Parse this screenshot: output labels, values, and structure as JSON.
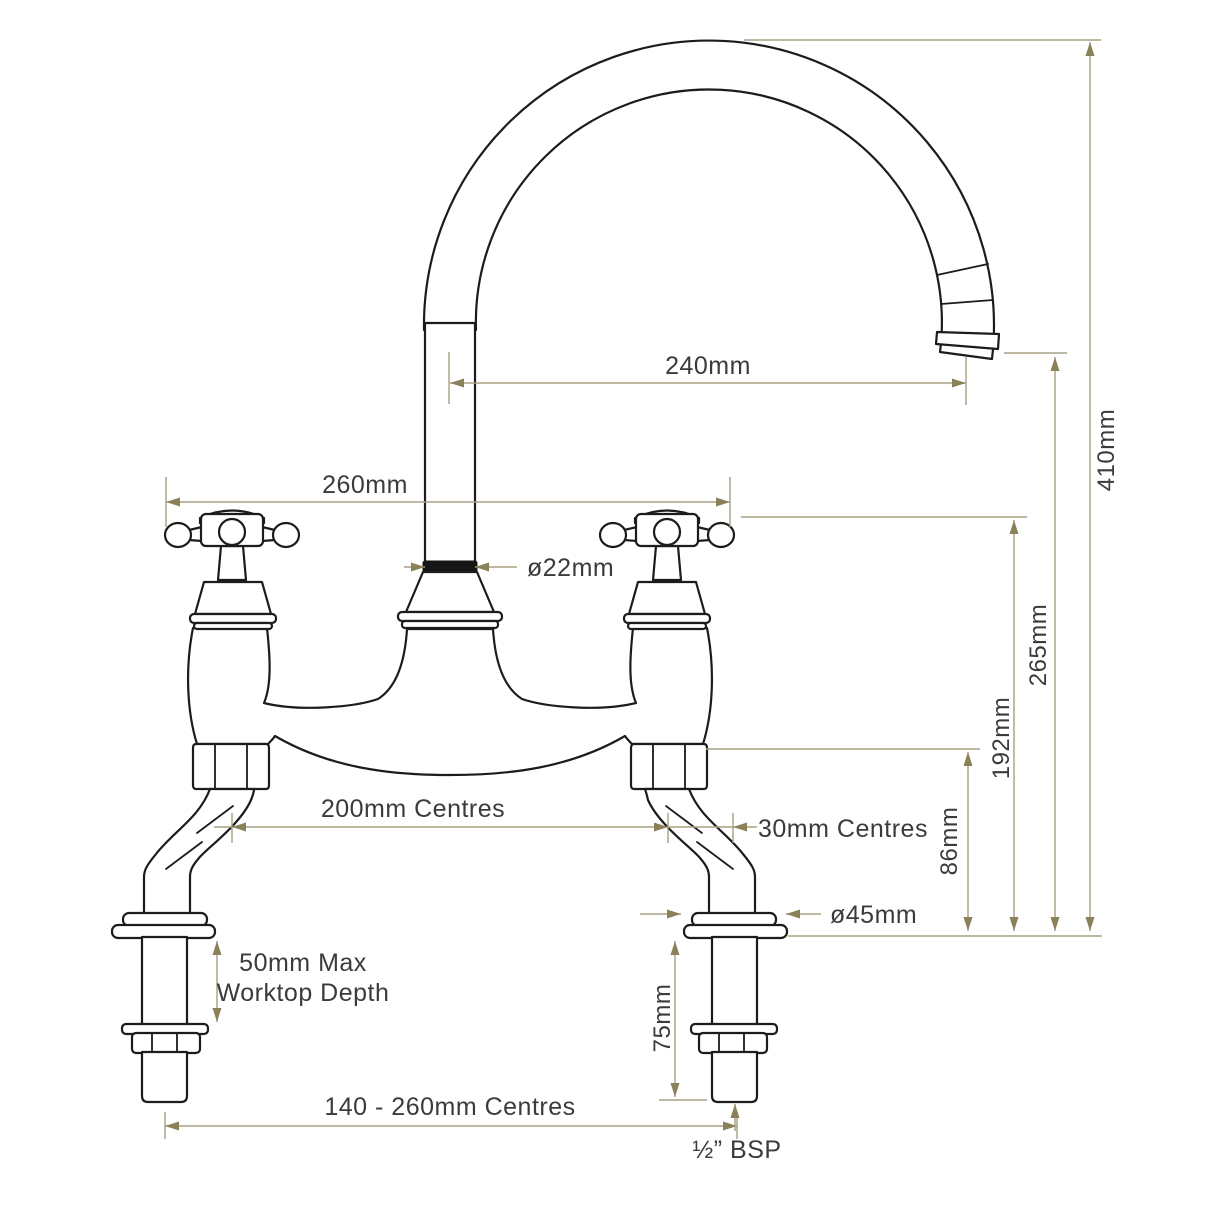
{
  "diagram": {
    "type": "technical-dimension-drawing",
    "subject": "two-hole bridge kitchen mixer tap with crosshead handles, front elevation",
    "dimensions": {
      "spout_reach": "240mm",
      "overall_width": "260mm",
      "spout_diameter": "ø22mm",
      "overall_height": "410mm",
      "spout_outlet_height": "265mm",
      "handle_top_height": "192mm",
      "inlet_body_height": "86mm",
      "tap_hole_centres": "200mm Centres",
      "offset_centres": "30mm Centres",
      "flange_diameter": "ø45mm",
      "worktop_depth_line1": "50mm Max",
      "worktop_depth_line2": "Worktop Depth",
      "shank_length": "75mm",
      "adjustable_inlet_centres": "140 - 260mm Centres",
      "thread_size": "½” BSP"
    },
    "colors": {
      "background": "#ffffff",
      "drawing_line": "#1c1c1c",
      "dimension_line": "#a6a084",
      "dimension_arrow": "#8a8159",
      "dimension_text": "#3b3b39"
    }
  }
}
